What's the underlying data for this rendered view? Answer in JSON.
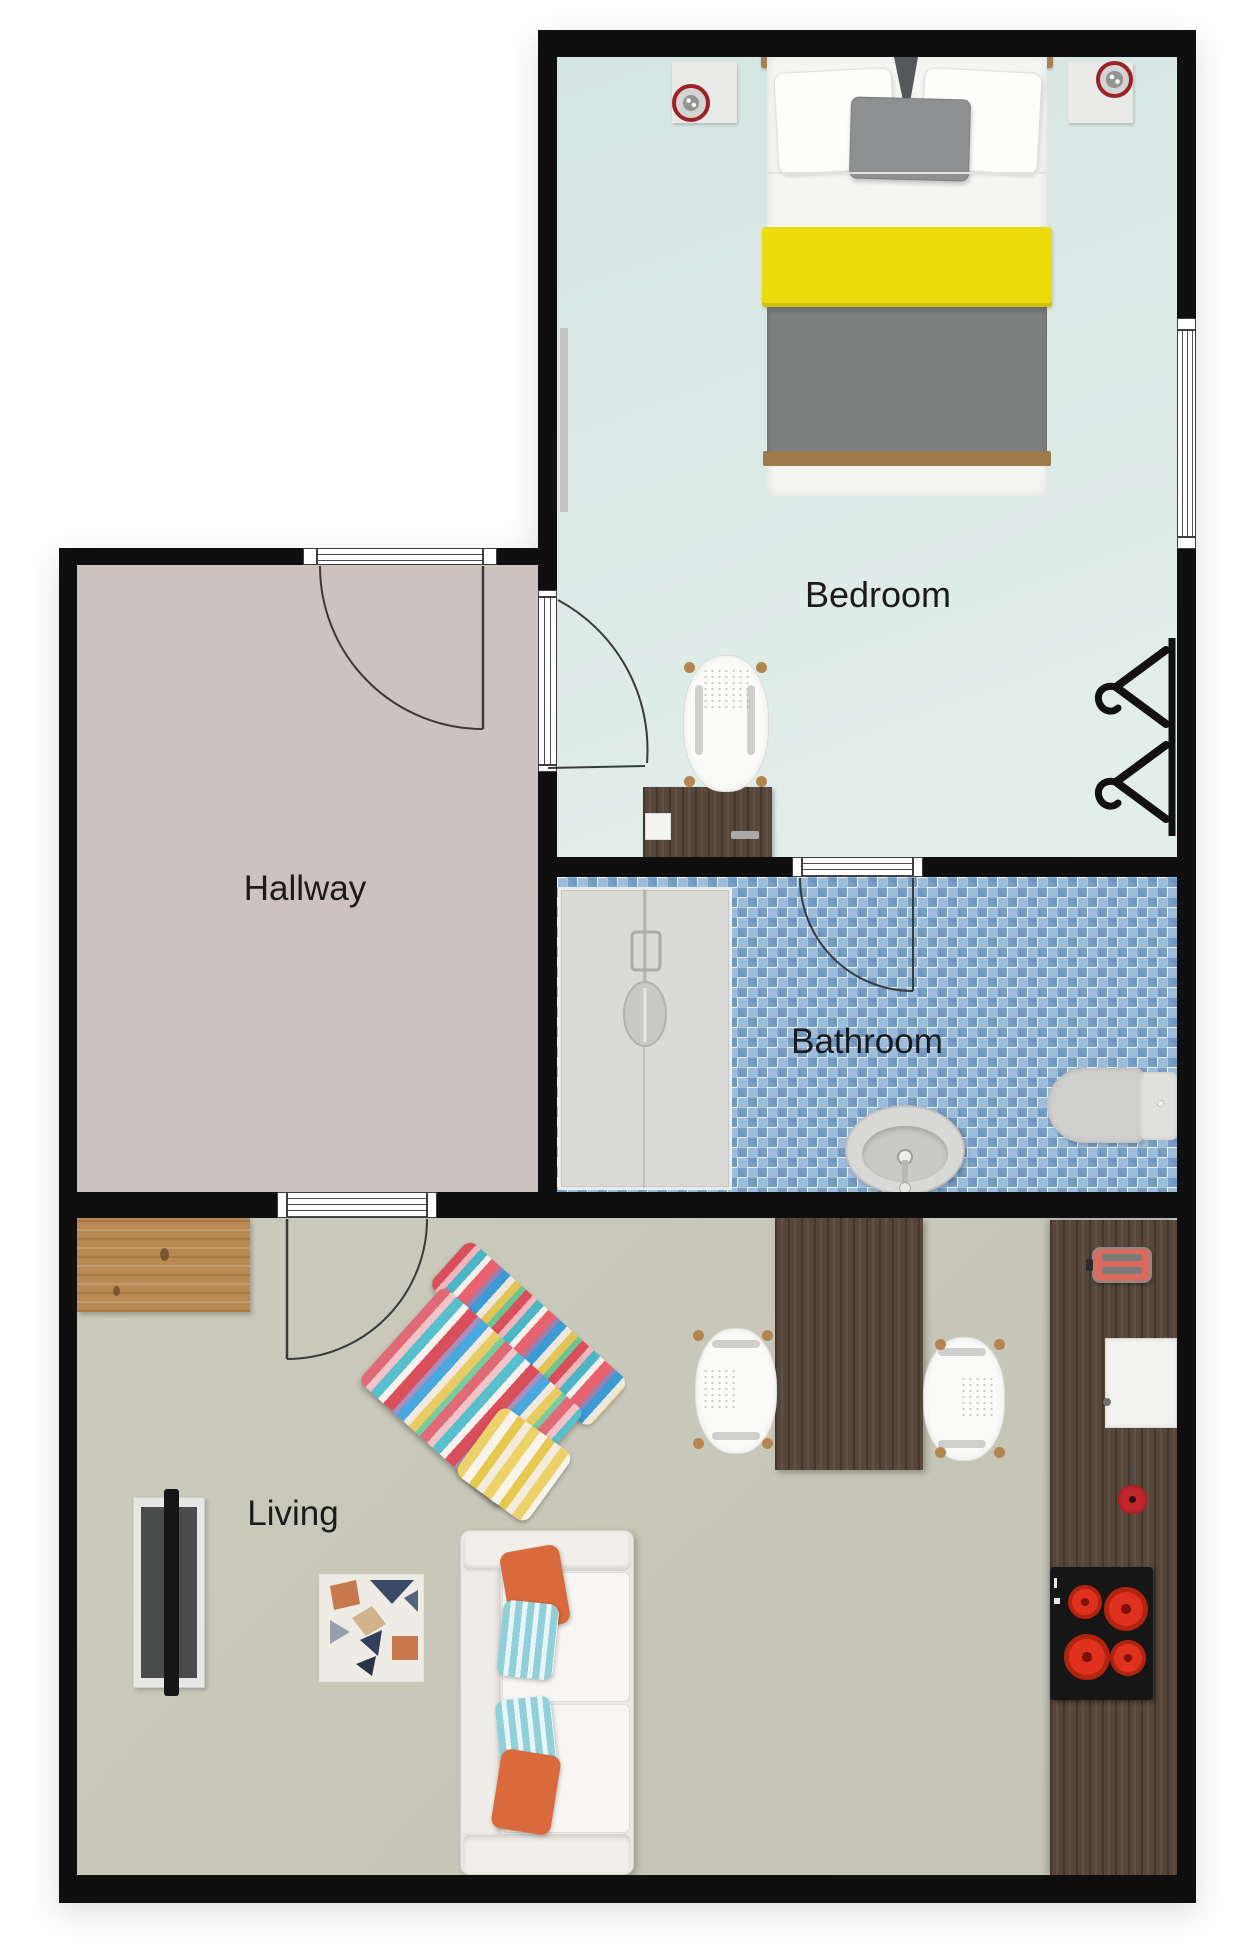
{
  "meta": {
    "type": "floor-plan",
    "view": "top-down"
  },
  "rooms": {
    "bedroom": {
      "label": "Bedroom",
      "floor_color": "#dbe8e5"
    },
    "hallway": {
      "label": "Hallway",
      "floor_color": "#ccc2c0"
    },
    "bathroom": {
      "label": "Bathroom",
      "floor_color": "#9dbdda"
    },
    "living": {
      "label": "Living",
      "floor_color": "#c8c8ba"
    }
  },
  "palette": {
    "wall": "#0f0f0f",
    "outside": "#ffffff",
    "bed_accent_yellow": "#ecdc0c",
    "bed_blanket_gray": "#7e807f",
    "wood_dark": "#57463a",
    "wood_light": "#b98a54",
    "stove_burner_red": "#e0301e",
    "toaster_red": "#d96a5e",
    "speaker_ring_red": "#9c2228",
    "pillow_orange": "#d96a3b",
    "pillow_teal": "#8fd0da"
  },
  "furniture": {
    "bedroom": [
      "double-bed",
      "nightstand-left",
      "nightstand-right",
      "speaker-left",
      "speaker-right",
      "desk",
      "desk-chair",
      "clothes-rack",
      "radiator",
      "window-right"
    ],
    "bathroom": [
      "shower-cabin",
      "washbasin",
      "toilet"
    ],
    "living": [
      "sideboard",
      "tv",
      "geometric-rug",
      "striped-armchair",
      "sofa",
      "dining-table",
      "dining-chair-left",
      "dining-chair-right",
      "kitchen-counter",
      "toaster",
      "kitchen-sink",
      "saucepan",
      "stove"
    ]
  },
  "doors": [
    "entry-door",
    "bedroom-door",
    "bathroom-door",
    "living-door"
  ]
}
